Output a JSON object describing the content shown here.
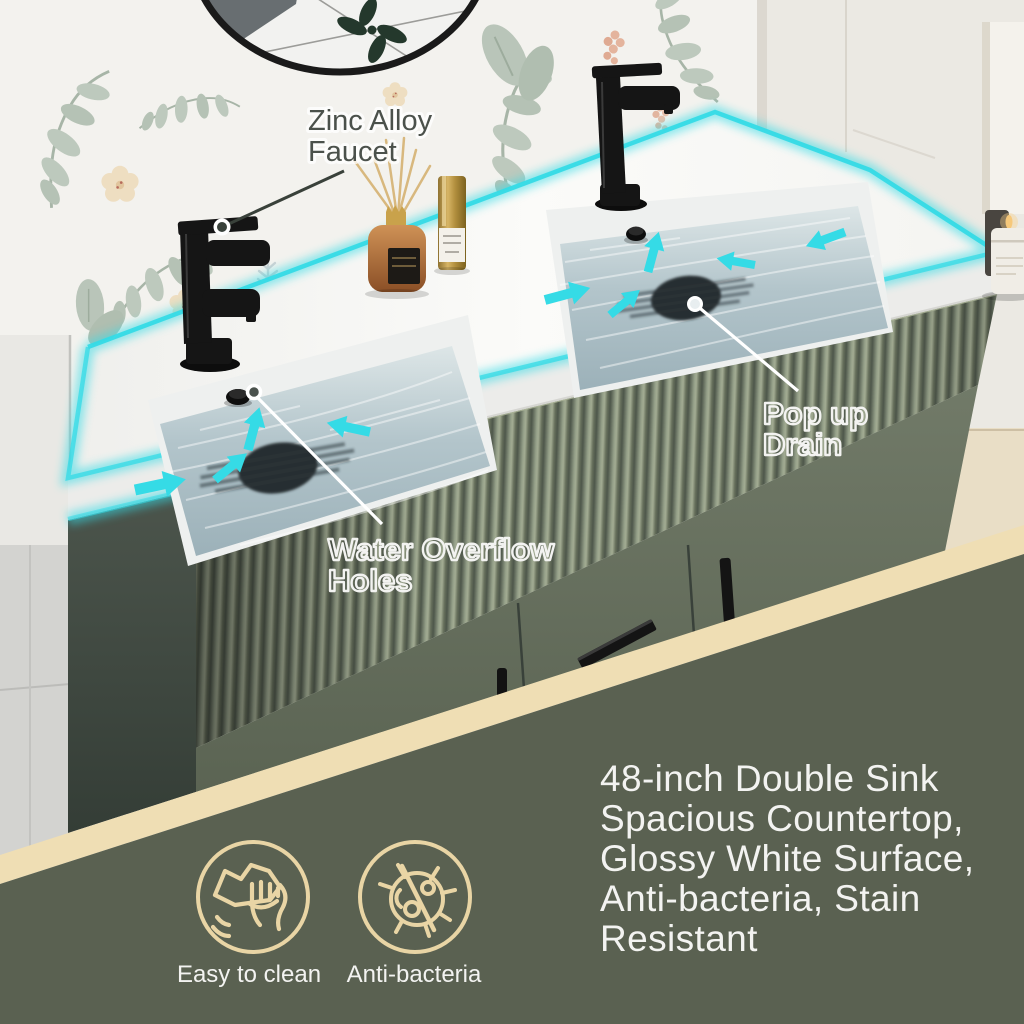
{
  "callouts": {
    "faucet": {
      "line1": "Zinc Alloy",
      "line2": "Faucet"
    },
    "drain": {
      "line1": "Pop up",
      "line2": "Drain"
    },
    "overflow": {
      "line1": "Water Overflow",
      "line2": "Holes"
    }
  },
  "features": [
    {
      "icon": "hand-wipe-icon",
      "label": "Easy to clean"
    },
    {
      "icon": "anti-bacteria-icon",
      "label": "Anti-bacteria"
    }
  ],
  "description": {
    "lines": [
      "48-inch Double Sink",
      "Spacious Countertop,",
      "Glossy White Surface,",
      "Anti-bacteria, Stain",
      "Resistant"
    ]
  },
  "colors": {
    "accent_cyan": "#35dbe6",
    "panel_olive": "#5a6151",
    "stripe_beige": "#efdeb4",
    "icon_tan": "#e9d5a5",
    "text_white": "#f3f3f1",
    "callout_text_dark": "#4b514b",
    "cabinet_green_light": "#97a18a",
    "cabinet_green_dark": "#515a4c",
    "countertop_white": "#fafaf8",
    "water_blue_gray": "#aebfc6",
    "faucet_black": "#191919"
  }
}
